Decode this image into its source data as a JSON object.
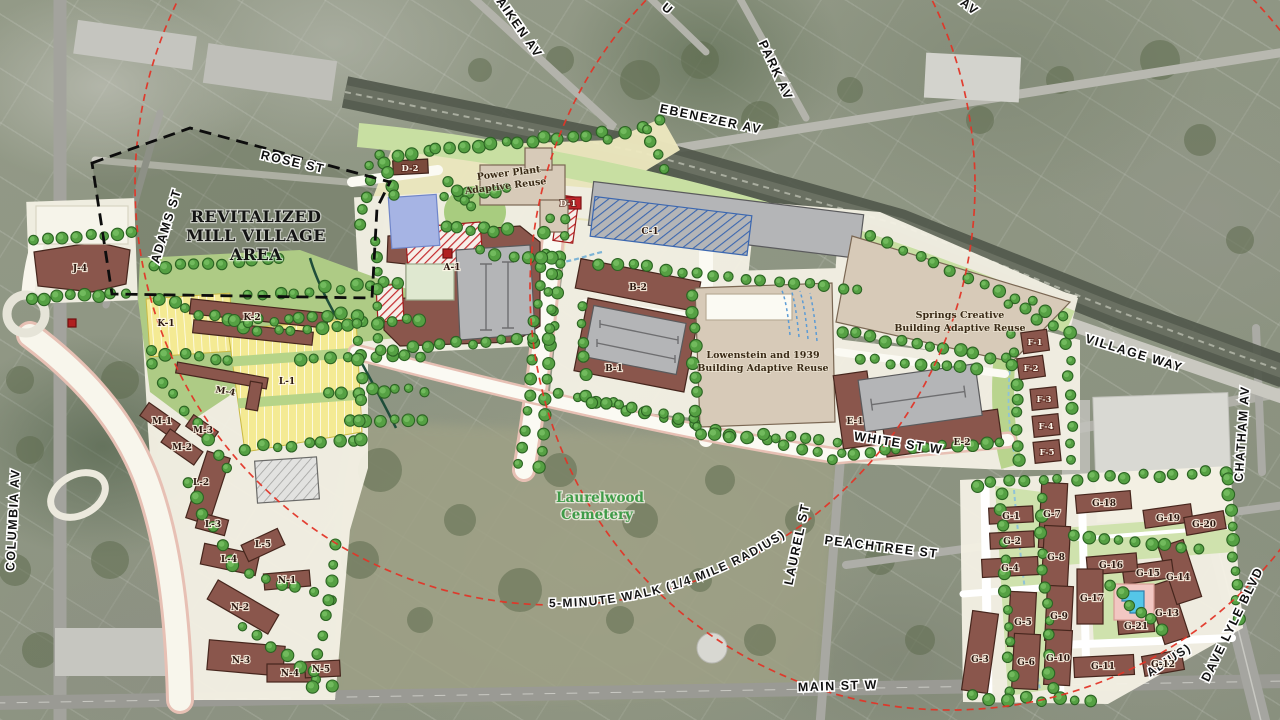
{
  "streets": {
    "rose": "ROSE ST",
    "adams": "ADAMS ST",
    "ebenezer": "EBENEZER AV",
    "aiken": "AIKEN AV",
    "u_partial": "U",
    "av_partial": "AV",
    "park": "PARK AV",
    "village_way": "VILLAGE WAY",
    "chatham": "CHATHAM AV",
    "white": "WHITE ST W",
    "laurel": "LAUREL ST",
    "peachtree": "PEACHTREE ST",
    "main": "MAIN ST W",
    "columbia": "COLUMBIA AV",
    "dave_lyle": "DAVE LYLE BLVD"
  },
  "parcels": {
    "a1": "A-1",
    "b1": "B-1",
    "b2": "B-2",
    "c1": "C-1",
    "d1": "D-1",
    "d2": "D-2",
    "e1": "E-1",
    "e2": "E-2",
    "f1": "F-1",
    "f2": "F-2",
    "f3": "F-3",
    "f4": "F-4",
    "f5": "F-5",
    "g1": "G-1",
    "g2": "G-2",
    "g3": "G-3",
    "g4": "G-4",
    "g5": "G-5",
    "g6": "G-6",
    "g7": "G-7",
    "g8": "G-8",
    "g9": "G-9",
    "g10": "G-10",
    "g11": "G-11",
    "g12": "G-12",
    "g13": "G-13",
    "g14": "G-14",
    "g15": "G-15",
    "g16": "G-16",
    "g17": "G-17",
    "g18": "G-18",
    "g19": "G-19",
    "g20": "G-20",
    "g21": "G-21",
    "j4": "J-4",
    "k1": "K-1",
    "k2": "K-2",
    "l1": "L-1",
    "l2": "L-2",
    "l3": "L-3",
    "l4": "L-4",
    "l5": "L-5",
    "m1": "M-1",
    "m2": "M-2",
    "m3": "M-3",
    "m4": "M-4",
    "n1": "N-1",
    "n2": "N-2",
    "n3": "N-3",
    "n4": "N-4",
    "n5": "N-5"
  },
  "annotations": {
    "mill_village": [
      "REVITALIZED",
      "MILL VILLAGE",
      "AREA"
    ],
    "cemetery": [
      "Laurelwood",
      "Cemetery"
    ],
    "walk_radius": "5-MINUTE WALK (1/4 MILE RADIUS)",
    "walk_radius_fragment": "ADIUS)"
  },
  "notes": {
    "power_plant": [
      "Power Plant",
      "Adaptive Reuse"
    ],
    "lowenstein": [
      "Lowenstein and 1939",
      "Building Adaptive Reuse"
    ],
    "springs": [
      "Springs Creative",
      "Building Adaptive Reuse"
    ]
  },
  "colors": {
    "radius_dash_red": "#e23527",
    "tree_green": "#55a043",
    "building_brown": "#8a564c",
    "adaptive_tan": "#d7cab8",
    "townhome_yellow": "#f4ea93",
    "parking_gray": "#b4b5b7",
    "pond_blue": "#a6b4e4",
    "pool_blue": "#55c6e8",
    "plan_base": "#f4f1e4",
    "plan_green": "#cfe2ad"
  }
}
